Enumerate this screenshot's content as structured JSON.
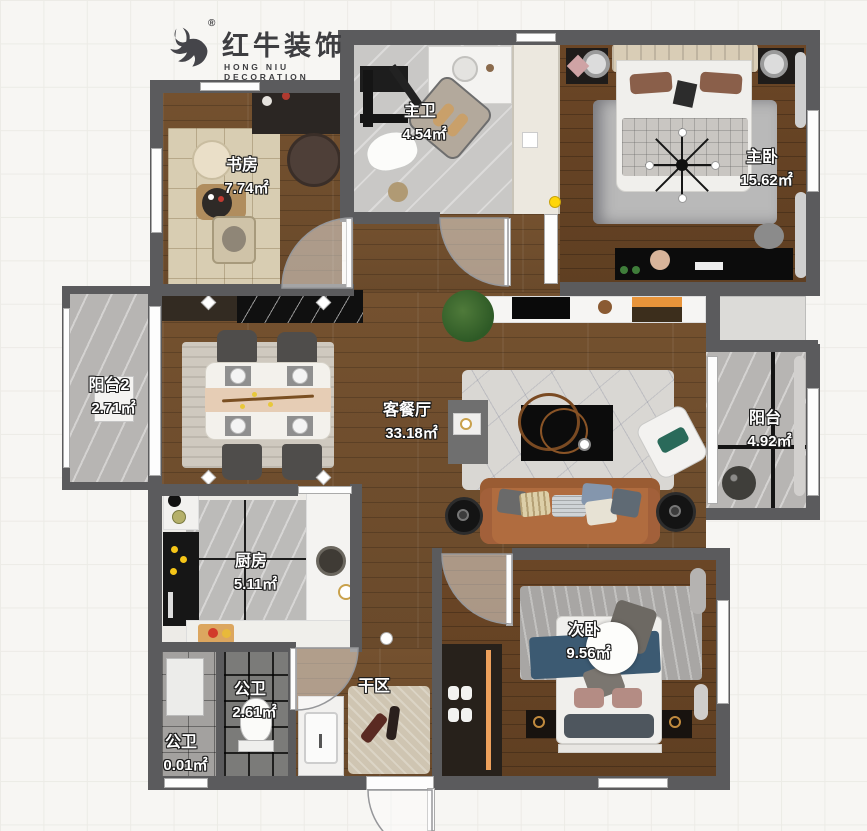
{
  "logo": {
    "icon": "bull-icon",
    "registered": "®",
    "brand": "红牛装饰",
    "subtitle": "HONG NIU DECORATION"
  },
  "rooms": [
    {
      "id": "study",
      "name": "书房",
      "area": "7.74㎡"
    },
    {
      "id": "master-bath",
      "name": "主卫",
      "area": "4.54㎡"
    },
    {
      "id": "master-bedroom",
      "name": "主卧",
      "area": "15.62㎡"
    },
    {
      "id": "balcony-2",
      "name": "阳台2",
      "area": "2.71㎡"
    },
    {
      "id": "living-dining",
      "name": "客餐厅",
      "area": "33.18㎡"
    },
    {
      "id": "balcony",
      "name": "阳台",
      "area": "4.92㎡"
    },
    {
      "id": "kitchen",
      "name": "厨房",
      "area": "5.11㎡"
    },
    {
      "id": "second-bedroom",
      "name": "次卧",
      "area": "9.56㎡"
    },
    {
      "id": "guest-bath",
      "name": "公卫",
      "area": "2.61㎡"
    },
    {
      "id": "dry-area",
      "name": "干区",
      "area": ""
    },
    {
      "id": "guest-bath-2",
      "name": "公卫",
      "area": "0.01㎡"
    }
  ],
  "colors": {
    "wall": "#5b5b5d",
    "wood_floor": "#74512f",
    "gray_tile": "#c9c8c6",
    "accent_yellow": "#ffd60a",
    "cabinet_orange": "#eda05c",
    "label_text": "#ffffff",
    "label_outline": "#1c1c1c"
  }
}
